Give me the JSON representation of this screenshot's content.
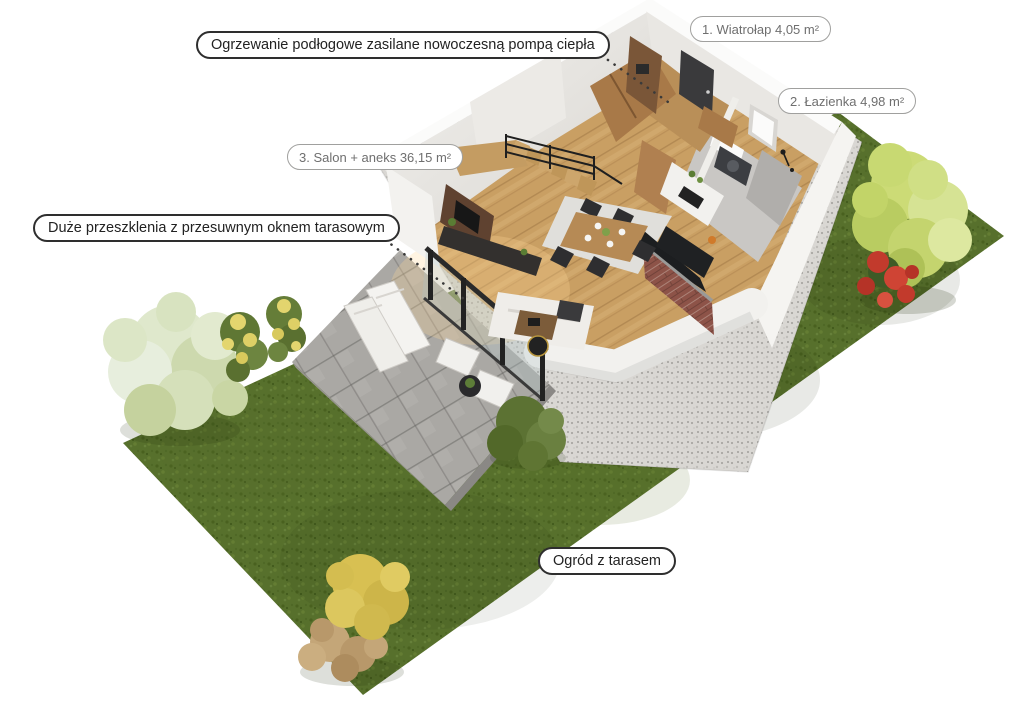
{
  "scene": {
    "kind": "3D cutaway floor plan of a house ground floor with garden",
    "background": "#ffffff"
  },
  "labels": {
    "features": [
      {
        "id": "heating",
        "text": "Ogrzewanie podłogowe zasilane nowoczesną pompą ciepła"
      },
      {
        "id": "glazing",
        "text": "Duże przeszklenia z przesuwnym oknem tarasowym"
      },
      {
        "id": "garden",
        "text": "Ogród z tarasem"
      }
    ],
    "rooms": [
      {
        "number": "1",
        "name": "Wiatrołap",
        "area": "4,05 m²",
        "text": "1. Wiatrołap 4,05 m²"
      },
      {
        "number": "2",
        "name": "Łazienka",
        "area": "4,98 m²",
        "text": "2. Łazienka 4,98 m²"
      },
      {
        "number": "3",
        "name": "Salon + aneks",
        "area": "36,15 m²",
        "text": "3. Salon + aneks 36,15 m²"
      }
    ]
  },
  "colors": {
    "grass": "#57702c",
    "gravel": "#d9d7d3",
    "terrace": "#aaa8a4",
    "walls_white": "#f4f3f0",
    "wood_floor": "#c99f63",
    "brick": "#8d5348",
    "foliage_green": "#c9d873",
    "foliage_white": "#dfe8cc",
    "flowers_red": "#c23a2c",
    "flowers_yellow": "#e3d56e",
    "label_border_dark": "#2e2e2e",
    "label_border_light": "#a0a09e",
    "label_text_dark": "#222222",
    "label_text_light": "#6f6f6f"
  }
}
